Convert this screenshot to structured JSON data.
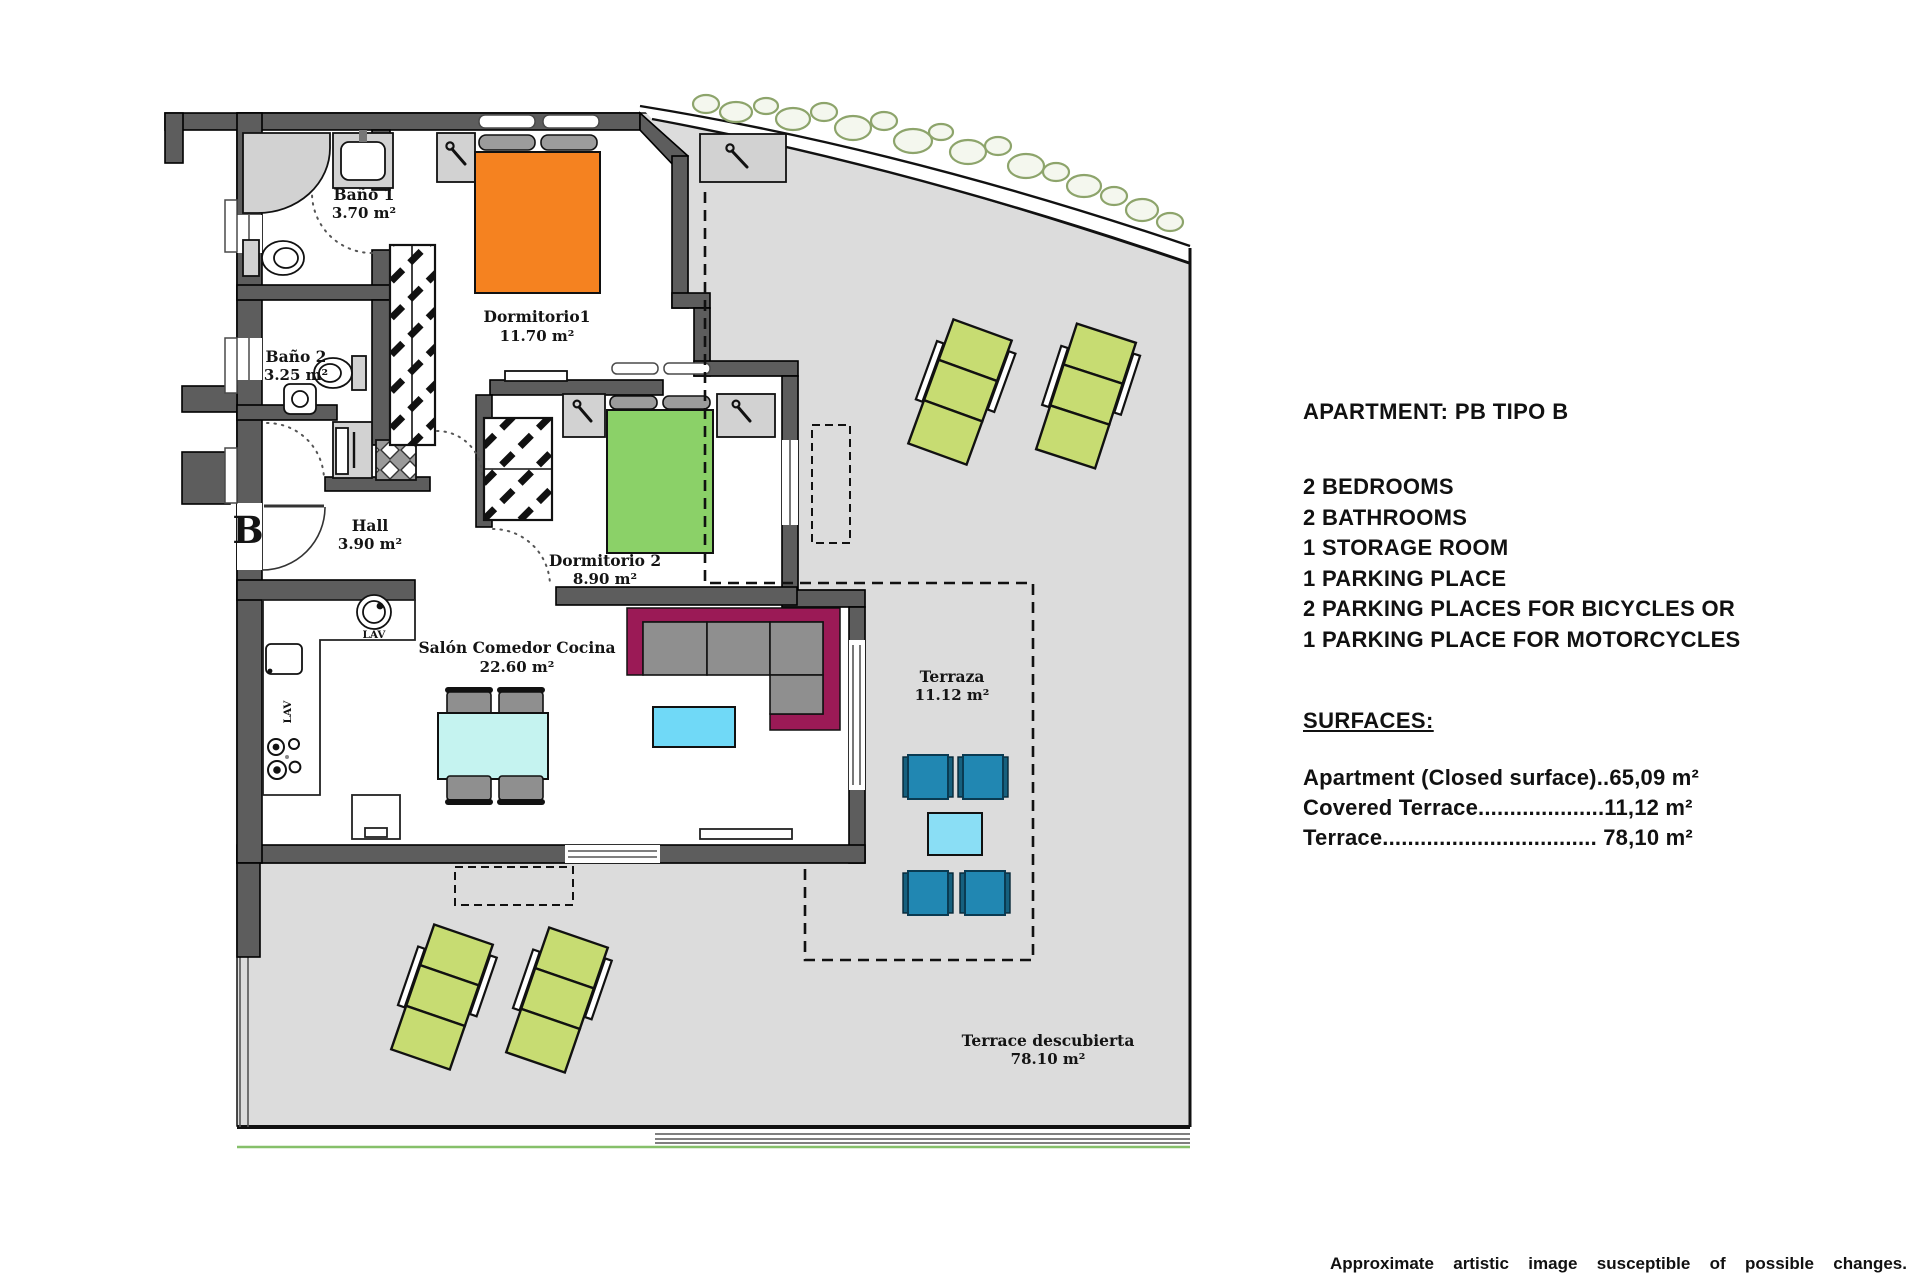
{
  "plan": {
    "unit_label": "B",
    "rooms": {
      "bano1": {
        "name": "Baño 1",
        "area": "3.70 m²"
      },
      "bano2": {
        "name": "Baño 2",
        "area": "3.25 m²"
      },
      "hall": {
        "name": "Hall",
        "area": "3.90 m²"
      },
      "dormitorio1": {
        "name": "Dormitorio1",
        "area": "11.70 m²"
      },
      "dormitorio2": {
        "name": "Dormitorio 2",
        "area": "8.90 m²"
      },
      "salon": {
        "name": "Salón Comedor Cocina",
        "area": "22.60 m²"
      },
      "terraza": {
        "name": "Terraza",
        "area": "11.12 m²"
      },
      "terrace_descubierta": {
        "name": "Terrace descubierta",
        "area": "78.10 m²"
      }
    },
    "appliances": {
      "washer": "LAV",
      "dishwasher": "LAV"
    }
  },
  "info_panel": {
    "title": "APARTMENT: PB TIPO B",
    "features": [
      "2 BEDROOMS",
      "2 BATHROOMS",
      "1 STORAGE ROOM",
      "1 PARKING PLACE",
      "2 PARKING PLACES FOR BICYCLES OR",
      "1 PARKING PLACE FOR MOTORCYCLES"
    ],
    "surfaces_heading": "SURFACES:",
    "surfaces": [
      "Apartment (Closed surface)..65,09 m²",
      "Covered Terrace....................11,12 m²",
      "Terrace.................................. 78,10 m²"
    ]
  },
  "footer": {
    "disclaimer": "Approximate artistic image susceptible of possible changes."
  },
  "colors": {
    "wall": "#5d5d5d",
    "terrace_floor": "#dcdcdc",
    "bed_orange": "#f58220",
    "bed_green": "#8bd168",
    "lounger_green": "#c7dc72",
    "sofa_magenta": "#9b1a56",
    "cushion_gray": "#8f8f8f",
    "chair_blue": "#2187b2",
    "terrace_table_cyan": "#8adef5",
    "coffee_table_cyan": "#70d9f7",
    "dining_table_cyan": "#c5f3f0",
    "hedge_olive": "#8da46b",
    "ground_line_green": "#86c06a"
  }
}
